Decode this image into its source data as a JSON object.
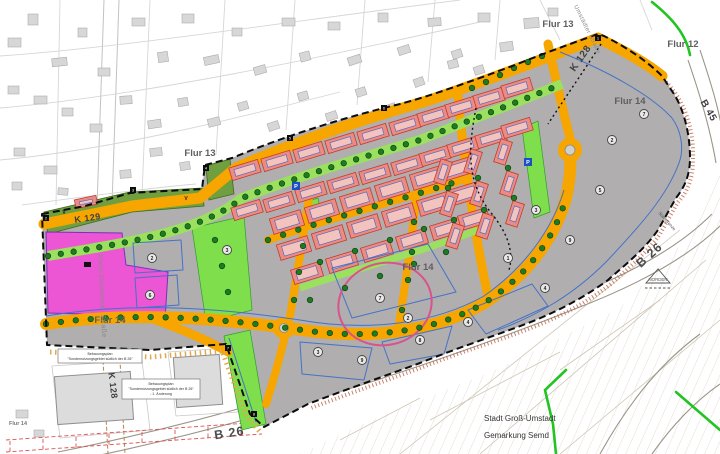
{
  "map": {
    "colors": {
      "road_orange": "#f7a600",
      "residential_red": "#ea8c84",
      "residential_stroke": "#c23b2e",
      "special_magenta": "#ec55d4",
      "plan_gray": "#b0aeae",
      "olive_green": "#6f9f3f",
      "bright_green": "#7ede4b",
      "axis_green": "#9ce060",
      "tree_green": "#1f7a24",
      "parcel_blue": "#4472c8",
      "municipal_green": "#21c421",
      "highlight_pink": "#d9538c"
    },
    "labels": {
      "flur13_west": "Flur 13",
      "flur13_north": "Flur 13",
      "flur12": "Flur 12",
      "flur14_ne": "Flur 14",
      "flur14_center": "Flur 14",
      "flur14_west": "Flur 14",
      "flur14_far_west": "Flur 14",
      "k128_ne": "K 128",
      "k128_sw": "K 128",
      "k129": "K 129",
      "b26_east": "B 26",
      "b26_south": "B 26",
      "b45": "B 45",
      "street_klein_zimmerner": "Klein-Zimmerner Straße",
      "street_umstaedter": "Umstädter Straße",
      "city": "Stadt Groß-Umstadt",
      "district": "Gemarkung Semd",
      "north_label": "NORDEN",
      "municipal_boundary": "Stadtgrenze",
      "parking": "P",
      "v_mark": "V"
    },
    "plan_notes": {
      "note1": {
        "line1": "Bebauungsplan",
        "line2": "\"Sondernutzungsgebiet südlich der B 26\""
      },
      "note2": {
        "line1": "Bebauungsplan",
        "line2": "\"Sondernutzungsgebiet südlich der B 26\"",
        "line3": "- 1. Änderung"
      }
    },
    "parcel_markers": [
      {
        "x": 152,
        "y": 258,
        "n": "2"
      },
      {
        "x": 150,
        "y": 295,
        "n": "6"
      },
      {
        "x": 227,
        "y": 250,
        "n": "3"
      },
      {
        "x": 318,
        "y": 352,
        "n": "3"
      },
      {
        "x": 362,
        "y": 360,
        "n": "9"
      },
      {
        "x": 420,
        "y": 340,
        "n": "8"
      },
      {
        "x": 468,
        "y": 322,
        "n": "4"
      },
      {
        "x": 380,
        "y": 298,
        "n": "7"
      },
      {
        "x": 408,
        "y": 318,
        "n": "2"
      },
      {
        "x": 536,
        "y": 210,
        "n": "3"
      },
      {
        "x": 570,
        "y": 240,
        "n": "9"
      },
      {
        "x": 600,
        "y": 190,
        "n": "5"
      },
      {
        "x": 612,
        "y": 140,
        "n": "2"
      },
      {
        "x": 644,
        "y": 114,
        "n": "7"
      },
      {
        "x": 508,
        "y": 258,
        "n": "1"
      },
      {
        "x": 545,
        "y": 288,
        "n": "4"
      }
    ],
    "boundary_markers": [
      {
        "x": 206,
        "y": 168,
        "n": "4"
      },
      {
        "x": 290,
        "y": 138,
        "n": "5"
      },
      {
        "x": 384,
        "y": 108,
        "n": "6"
      },
      {
        "x": 133,
        "y": 190,
        "n": "3"
      },
      {
        "x": 46,
        "y": 218,
        "n": "2"
      },
      {
        "x": 228,
        "y": 348,
        "n": "7"
      },
      {
        "x": 254,
        "y": 414,
        "n": "8"
      },
      {
        "x": 598,
        "y": 38,
        "n": "1"
      }
    ],
    "p_markers": [
      {
        "x": 528,
        "y": 162
      },
      {
        "x": 296,
        "y": 186
      }
    ],
    "v_markers": [
      {
        "x": 64,
        "y": 214
      },
      {
        "x": 186,
        "y": 200
      }
    ]
  }
}
